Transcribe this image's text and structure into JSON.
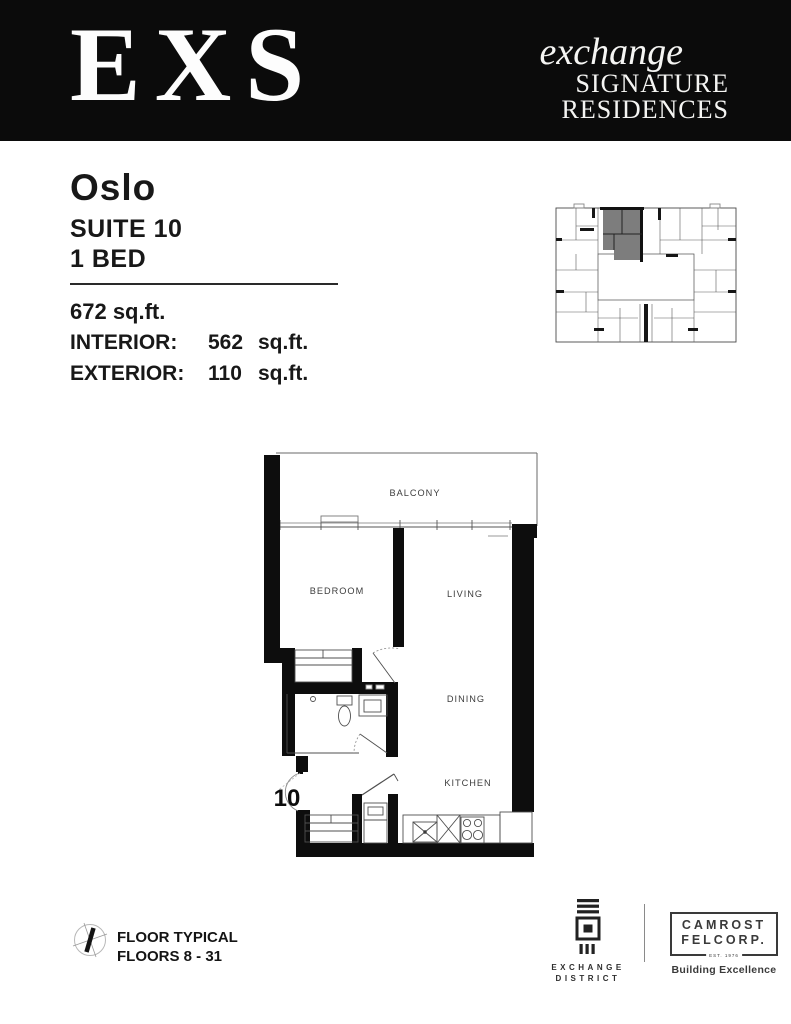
{
  "page": {
    "accent": "#0b0b0b",
    "highlight_gray": "#7d7d7d"
  },
  "header": {
    "logo": "EXS",
    "brand_italic": "exchange",
    "brand_line2": "SIGNATURE",
    "brand_line3": "RESIDENCES"
  },
  "suite": {
    "name": "Oslo",
    "suite_label": "SUITE 10",
    "bed_label": "1 BED",
    "total_area": "672 sq.ft.",
    "interior": {
      "label": "INTERIOR:",
      "value": "562",
      "unit": "sq.ft."
    },
    "exterior": {
      "label": "EXTERIOR:",
      "value": "110",
      "unit": "sq.ft."
    }
  },
  "floorplan": {
    "suite_number": "10",
    "labels": {
      "balcony": "BALCONY",
      "bedroom": "BEDROOM",
      "living": "LIVING",
      "dining": "DINING",
      "kitchen": "KITCHEN"
    }
  },
  "footer": {
    "floor_typical": "FLOOR TYPICAL",
    "floors_range": "FLOORS 8 - 31",
    "exchange_district": {
      "line1": "EXCHANGE",
      "line2": "DISTRICT"
    },
    "camrost": {
      "line1": "CAMROST",
      "line2": "FELCORP.",
      "est": "EST. 1976",
      "tagline": "Building Excellence"
    }
  }
}
